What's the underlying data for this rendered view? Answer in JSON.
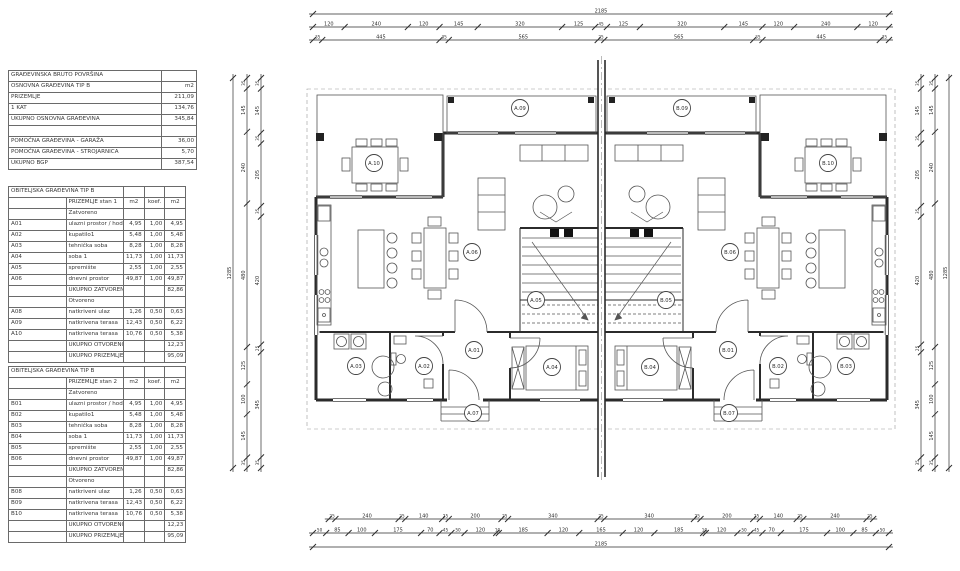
{
  "summary_table": {
    "name": "gross-building-area",
    "rows": [
      {
        "label": "GRAĐEVINSKA BRUTO POVRŠINA",
        "value": ""
      },
      {
        "label": "OSNOVNA GRAĐEVINA TIP B",
        "value": "m2"
      },
      {
        "label": "PRIZEMLJE",
        "value": "211,09"
      },
      {
        "label": "1 KAT",
        "value": "134,76"
      },
      {
        "label": "UKUPNO OSNOVNA GRAĐEVINA",
        "value": "345,84"
      },
      {
        "label": "",
        "value": ""
      },
      {
        "label": "POMOĆNA GRAĐEVINA - GARAŽA",
        "value": "36,00"
      },
      {
        "label": "POMOĆNA GRAĐEVINA - STROJARNICA",
        "value": "5,70"
      },
      {
        "label": "UKUPNO BGP",
        "value": "387,54"
      }
    ]
  },
  "unit_tables": [
    {
      "title": "OBITELJSKA GRAĐEVINA TIP B",
      "subtitle": "PRIZEMLJE stan 1",
      "col_headers": [
        "m2",
        "koef.",
        "m2"
      ],
      "sections": [
        {
          "label": "Zatvoreno",
          "rows": [
            {
              "code": "A01",
              "name": "ulazni prostor / hodnik",
              "area": "4,95",
              "koef": "1,00",
              "result": "4,95"
            },
            {
              "code": "A02",
              "name": "kupatilo1",
              "area": "5,48",
              "koef": "1,00",
              "result": "5,48"
            },
            {
              "code": "A03",
              "name": "tehnička soba",
              "area": "8,28",
              "koef": "1,00",
              "result": "8,28"
            },
            {
              "code": "A04",
              "name": "soba 1",
              "area": "11,73",
              "koef": "1,00",
              "result": "11,73"
            },
            {
              "code": "A05",
              "name": "spremište",
              "area": "2,55",
              "koef": "1,00",
              "result": "2,55"
            },
            {
              "code": "A06",
              "name": "dnevni prostor",
              "area": "49,87",
              "koef": "1,00",
              "result": "49,87"
            }
          ],
          "total_label": "UKUPNO ZATVORENO",
          "total_value": "82,86"
        },
        {
          "label": "Otvoreno",
          "rows": [
            {
              "code": "A08",
              "name": "natkriveni ulaz",
              "area": "1,26",
              "koef": "0,50",
              "result": "0,63"
            },
            {
              "code": "A09",
              "name": "natkrivena terasa",
              "area": "12,43",
              "koef": "0,50",
              "result": "6,22"
            },
            {
              "code": "A10",
              "name": "natkrivena terasa",
              "area": "10,76",
              "koef": "0,50",
              "result": "5,38"
            }
          ],
          "total_label": "UKUPNO OTVORENO",
          "total_value": "12,23"
        }
      ],
      "grand_total_label": "UKUPNO PRIZEMLJE",
      "grand_total_value": "95,09"
    },
    {
      "title": "OBITELJSKA GRAĐEVINA TIP B",
      "subtitle": "PRIZEMLJE stan 2",
      "col_headers": [
        "m2",
        "koef.",
        "m2"
      ],
      "sections": [
        {
          "label": "Zatvoreno",
          "rows": [
            {
              "code": "B01",
              "name": "ulazni prostor / hodnik",
              "area": "4,95",
              "koef": "1,00",
              "result": "4,95"
            },
            {
              "code": "B02",
              "name": "kupatilo1",
              "area": "5,48",
              "koef": "1,00",
              "result": "5,48"
            },
            {
              "code": "B03",
              "name": "tehnička soba",
              "area": "8,28",
              "koef": "1,00",
              "result": "8,28"
            },
            {
              "code": "B04",
              "name": "soba 1",
              "area": "11,73",
              "koef": "1,00",
              "result": "11,73"
            },
            {
              "code": "B05",
              "name": "spremište",
              "area": "2,55",
              "koef": "1,00",
              "result": "2,55"
            },
            {
              "code": "B06",
              "name": "dnevni prostor",
              "area": "49,87",
              "koef": "1,00",
              "result": "49,87"
            }
          ],
          "total_label": "UKUPNO ZATVORENO",
          "total_value": "82,86"
        },
        {
          "label": "Otvoreno",
          "rows": [
            {
              "code": "B08",
              "name": "natkriveni ulaz",
              "area": "1,26",
              "koef": "0,50",
              "result": "0,63"
            },
            {
              "code": "B09",
              "name": "natkrivena terasa",
              "area": "12,43",
              "koef": "0,50",
              "result": "6,22"
            },
            {
              "code": "B10",
              "name": "natkrivena terasa",
              "area": "10,76",
              "koef": "0,50",
              "result": "5,38"
            }
          ],
          "total_label": "UKUPNO OTVORENO",
          "total_value": "12,23"
        }
      ],
      "grand_total_label": "UKUPNO PRIZEMLJE",
      "grand_total_value": "95,09"
    }
  ],
  "dimensions": {
    "top_rows": [
      {
        "labels": [
          "2185"
        ]
      },
      {
        "labels": [
          "120",
          "240",
          "120",
          "145",
          "320",
          "125",
          "45",
          "125",
          "320",
          "145",
          "120",
          "240",
          "120"
        ]
      },
      {
        "labels": [
          "35",
          "445",
          "35",
          "565",
          "25",
          "565",
          "35",
          "445",
          "35"
        ]
      }
    ],
    "bottom_rows": [
      {
        "labels": [
          "25",
          "240",
          "25",
          "140",
          "25",
          "200",
          "25",
          "340",
          "25",
          "340",
          "25",
          "200",
          "25",
          "140",
          "25",
          "240",
          "25"
        ]
      },
      {
        "labels": [
          "50",
          "85",
          "100",
          "175",
          "70",
          "45",
          "50",
          "120",
          "10",
          "185",
          "120",
          "165",
          "120",
          "185",
          "10",
          "120",
          "50",
          "45",
          "70",
          "175",
          "100",
          "85",
          "50"
        ]
      },
      {
        "labels": [
          "2185"
        ]
      }
    ],
    "left_cols": [
      {
        "labels": [
          "1285"
        ]
      },
      {
        "labels": [
          "35",
          "145",
          "240",
          "480",
          "125",
          "100",
          "145",
          "35"
        ]
      },
      {
        "labels": [
          "35",
          "145",
          "35",
          "205",
          "35",
          "420",
          "25",
          "345",
          "35"
        ]
      }
    ],
    "right_cols": [
      {
        "labels": [
          "35",
          "145",
          "35",
          "205",
          "35",
          "420",
          "25",
          "345",
          "35"
        ]
      },
      {
        "labels": [
          "35",
          "145",
          "240",
          "480",
          "125",
          "100",
          "145",
          "35"
        ]
      },
      {
        "labels": [
          "1285"
        ]
      }
    ]
  },
  "room_labels": [
    {
      "id": "A.10",
      "x": 374,
      "y": 163
    },
    {
      "id": "A.09",
      "x": 520,
      "y": 108
    },
    {
      "id": "B.09",
      "x": 682,
      "y": 108
    },
    {
      "id": "B.10",
      "x": 828,
      "y": 163
    },
    {
      "id": "A.06",
      "x": 472,
      "y": 252
    },
    {
      "id": "B.06",
      "x": 730,
      "y": 252
    },
    {
      "id": "A.05",
      "x": 536,
      "y": 300
    },
    {
      "id": "B.05",
      "x": 666,
      "y": 300
    },
    {
      "id": "A.01",
      "x": 474,
      "y": 350
    },
    {
      "id": "B.01",
      "x": 728,
      "y": 350
    },
    {
      "id": "A.02",
      "x": 424,
      "y": 366
    },
    {
      "id": "B.02",
      "x": 778,
      "y": 366
    },
    {
      "id": "A.03",
      "x": 356,
      "y": 366
    },
    {
      "id": "B.03",
      "x": 846,
      "y": 366
    },
    {
      "id": "A.04",
      "x": 552,
      "y": 367
    },
    {
      "id": "B.04",
      "x": 650,
      "y": 367
    },
    {
      "id": "A.07",
      "x": 473,
      "y": 413
    },
    {
      "id": "B.07",
      "x": 729,
      "y": 413
    }
  ]
}
